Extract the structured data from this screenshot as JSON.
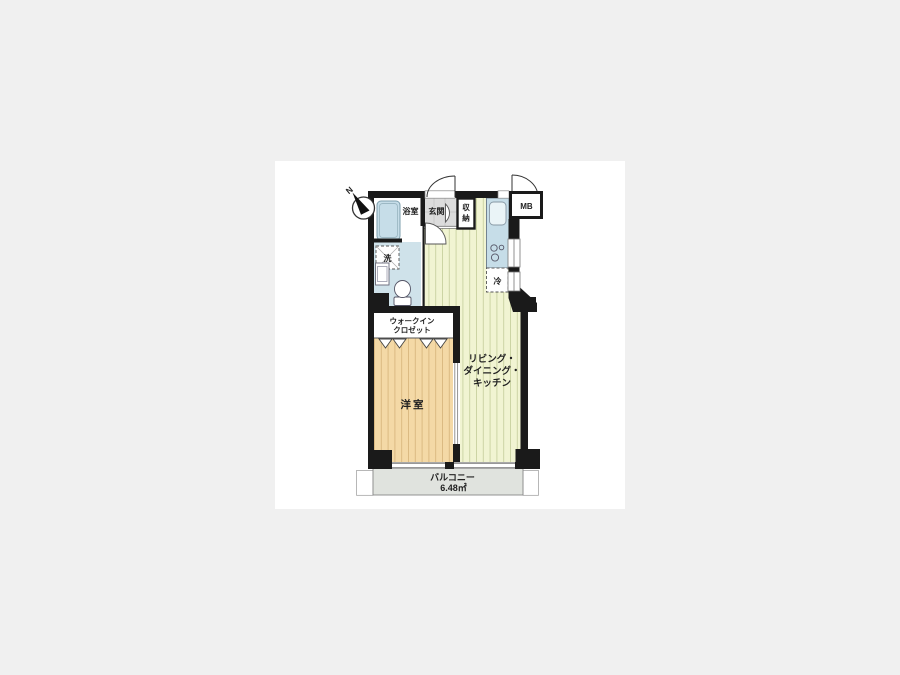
{
  "floorplan": {
    "compass": {
      "north_label": "N"
    },
    "rooms": {
      "bathroom": {
        "label": "浴室"
      },
      "entrance": {
        "label": "玄関"
      },
      "storage": {
        "chars": [
          "収",
          "納"
        ]
      },
      "meter_box": {
        "label": "MB"
      },
      "washer": {
        "label": "洗"
      },
      "fridge": {
        "label": "冷"
      },
      "walk_in_closet": {
        "label_line1": "ウォークイン",
        "label_line2": "クロゼット"
      },
      "western_room": {
        "label": "洋室"
      },
      "ldk": {
        "label_line1": "リビング・",
        "label_line2": "ダイニング・",
        "label_line3": "キッチン"
      },
      "balcony": {
        "label": "バルコニー",
        "area": "6.48㎡"
      }
    },
    "colors": {
      "wall": "#1a1a1a",
      "ldk_floor": "#f1f4d2",
      "room_floor": "#f4d9a6",
      "wet_floor": "#cfe2ea",
      "fixture_blue": "#c6dde8",
      "entrance_tile": "#dcdcdc",
      "balcony": "#e0e3de",
      "canvas": "#ffffff",
      "page_bg": "#f0f0f0"
    }
  }
}
